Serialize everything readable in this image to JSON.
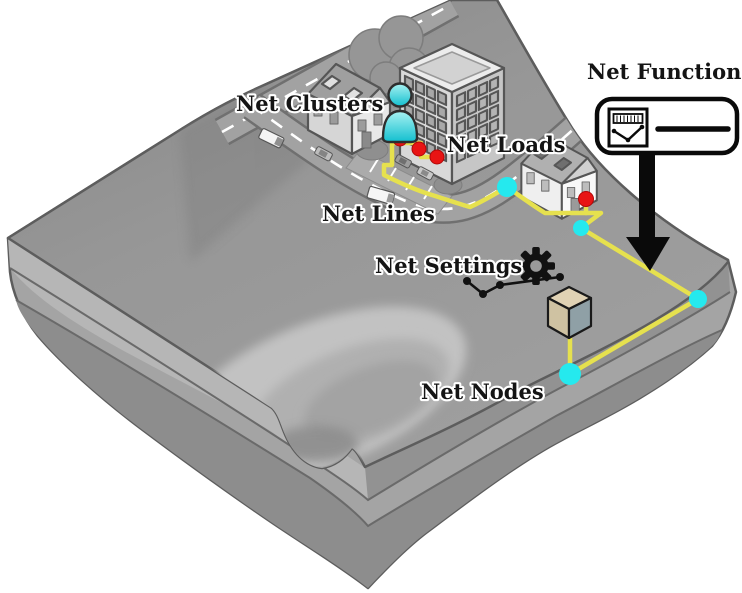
{
  "diagram": {
    "title": "Isometric network structure overview",
    "labels": {
      "functions": "Net Functions",
      "clusters": "Net Clusters",
      "loads": "Net Loads",
      "lines": "Net Lines",
      "settings": "Net Settings",
      "nodes": "Net Nodes"
    },
    "colors": {
      "net_line": "#e6e14e",
      "net_node": "#25e9ee",
      "net_load": "#e81414",
      "person": "#25c8d8",
      "terrain_top": "#9a9a9a",
      "terrain_side": "#a4a4a4",
      "outline": "#5d5d5d",
      "arrow": "#0a0a0a"
    },
    "icons": {
      "functions_icon": "meter-and-function-box",
      "clusters_icon": "person",
      "settings_icon": "gear-with-graph",
      "nodes_icon": "cube",
      "arrow_icon": "down-arrow"
    },
    "counts": {
      "net_nodes": 4,
      "net_loads": 4
    }
  }
}
